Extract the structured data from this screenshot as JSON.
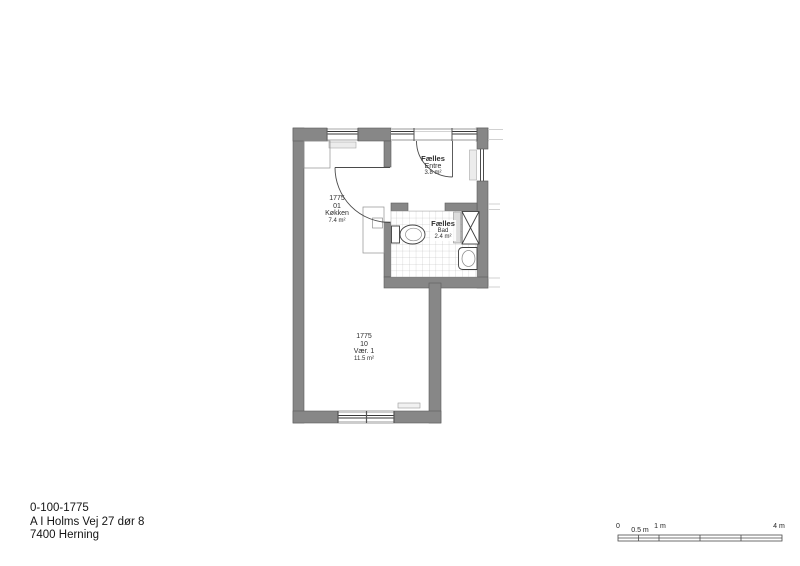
{
  "title_block": {
    "plan_number": "0-100-1775",
    "address": "A I Holms Vej 27 dør 8",
    "city": "7400 Herning"
  },
  "rooms": {
    "koekken": {
      "unit": "1775",
      "number": "01",
      "name": "Køkken",
      "area": "7.4 m²"
    },
    "entre": {
      "category": "Fælles",
      "name": "Entre",
      "area": "3.8 m²"
    },
    "bad": {
      "category": "Fælles",
      "name": "Bad",
      "area": "2.4 m²"
    },
    "vaer1": {
      "unit": "1775",
      "number": "10",
      "name": "Vær. 1",
      "area": "11.5 m²"
    }
  },
  "scale_bar": {
    "tick_labels": [
      "0",
      "0.5 m",
      "1 m",
      "4 m"
    ]
  },
  "colors": {
    "wall_fill": "#878787",
    "wall_edge": "#5c5c5c",
    "tile_line": "#b8b8b8",
    "fixture_stroke": "#3f3f3f",
    "text": "#2e2e2e"
  }
}
